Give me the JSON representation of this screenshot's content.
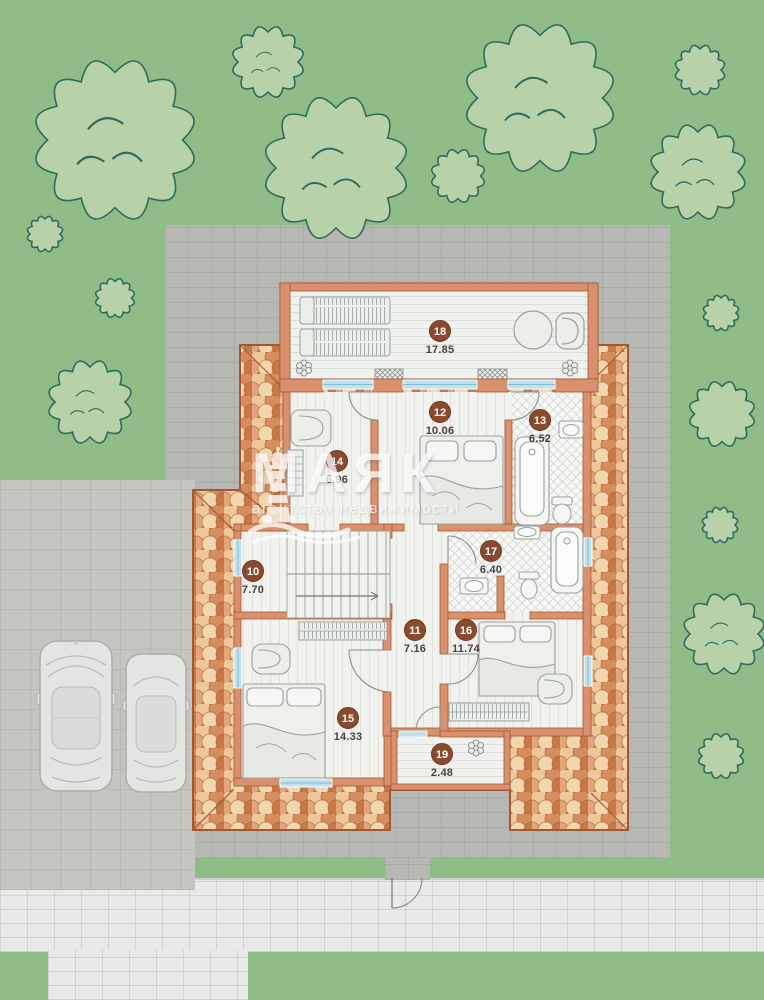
{
  "watermark": {
    "brand": "МАЯК",
    "tagline": "агентство недвижимости"
  },
  "plan": {
    "rooms": [
      {
        "number": "10",
        "area": "7.70"
      },
      {
        "number": "11",
        "area": "7.16"
      },
      {
        "number": "12",
        "area": "10.06"
      },
      {
        "number": "13",
        "area": "6.52"
      },
      {
        "number": "14",
        "area": "6.96"
      },
      {
        "number": "15",
        "area": "14.33"
      },
      {
        "number": "16",
        "area": "11.74"
      },
      {
        "number": "17",
        "area": "6.40"
      },
      {
        "number": "18",
        "area": "17.85"
      },
      {
        "number": "19",
        "area": "2.48"
      }
    ]
  },
  "colors": {
    "lawn": "#90bd87",
    "tree_fill": "#b7d2a8",
    "tree_outline": "#2f6b5e",
    "roof_tile_base": "#cd8050",
    "wall": "#d9906e",
    "wall_outline": "#a3592f",
    "floor": "#f1f2ee",
    "window": "#bfe2ee",
    "badge": "#8a4a2d",
    "paving_dark": "#b7b8b4",
    "paving_light": "#e9eae7"
  }
}
